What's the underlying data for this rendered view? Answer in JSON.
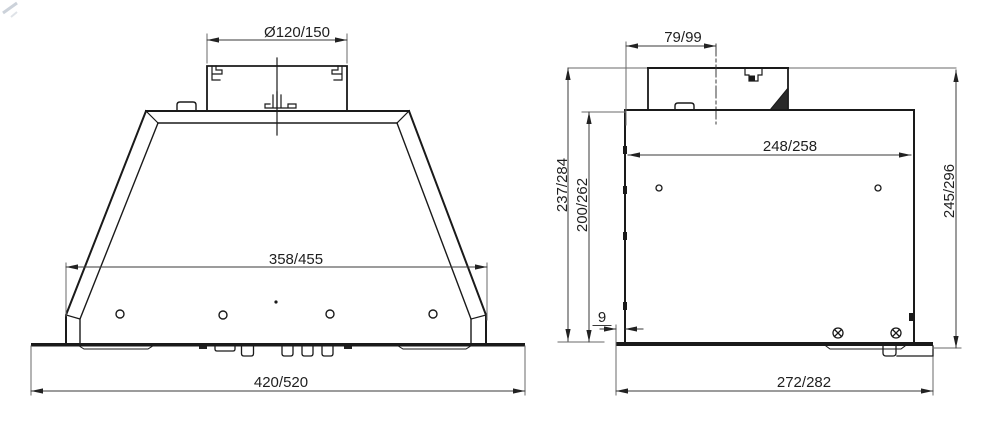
{
  "drawing": {
    "type": "technical-dimension-drawing",
    "views": {
      "front_view_name": "front-view",
      "side_view_name": "side-view"
    },
    "front_view": {
      "duct_diameter_label": "Ø120/150",
      "hood_width_label": "358/455",
      "overall_width_label": "420/520"
    },
    "side_view": {
      "duct_offset_label": "79/99",
      "top_width_label": "248/258",
      "overall_height_label": "237/284",
      "body_height_label": "200/262",
      "flange_offset_label": "9",
      "right_height_label": "245/296",
      "base_width_label": "272/282"
    },
    "colors": {
      "background": "#ffffff",
      "object_line": "#1a1a1a",
      "dimension_line": "#3a3a3a",
      "extension_line": "#6a6a6a",
      "text": "#1f1f1f"
    }
  }
}
